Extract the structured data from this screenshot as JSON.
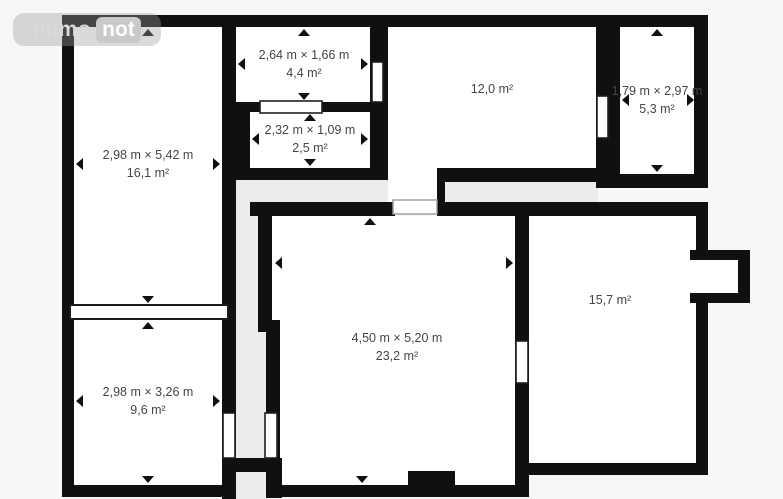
{
  "watermark": {
    "brand_left": "immo",
    "brand_right": "not"
  },
  "floor_plan": {
    "rooms": [
      {
        "id": "room-16-1",
        "dimensions": "2,98 m × 5,42 m",
        "area": "16,1 m²"
      },
      {
        "id": "room-9-6",
        "dimensions": "2,98 m × 3,26 m",
        "area": "9,6 m²"
      },
      {
        "id": "room-4-4",
        "dimensions": "2,64 m × 1,66 m",
        "area": "4,4 m²"
      },
      {
        "id": "room-2-5",
        "dimensions": "2,32 m × 1,09 m",
        "area": "2,5 m²"
      },
      {
        "id": "room-12-0",
        "area": "12,0 m²"
      },
      {
        "id": "room-5-3",
        "dimensions": "1,79 m × 2,97 m",
        "area": "5,3 m²"
      },
      {
        "id": "room-23-2",
        "dimensions": "4,50 m × 5,20 m",
        "area": "23,2 m²"
      },
      {
        "id": "room-15-7",
        "area": "15,7 m²"
      }
    ],
    "colors": {
      "wall": "#101010",
      "room_fill": "#ffffff",
      "hallway_fill": "#ececec",
      "background": "#f7f7f7",
      "label_text": "#454545"
    }
  }
}
